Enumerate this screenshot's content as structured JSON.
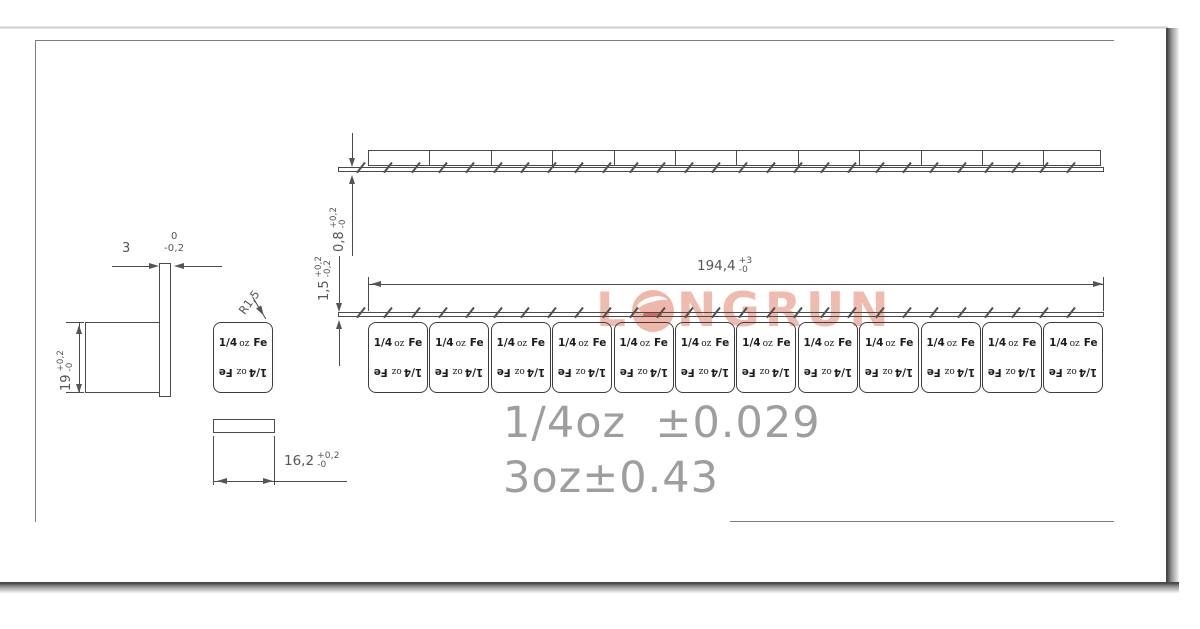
{
  "colors": {
    "drawing_line": "#4a4a4a",
    "dimension_text": "#555555",
    "note_text": "#9e9e9e",
    "watermark": "#eeb0a2"
  },
  "watermark": {
    "first_letter": "L",
    "rest": "NGRUN"
  },
  "weight_block": {
    "fraction": "1/4",
    "unit": "oz",
    "material": "Fe"
  },
  "strip": {
    "segment_count": 12
  },
  "dimensions": {
    "tape_thickness": {
      "value": "0,8",
      "tol_plus": "+0,2",
      "tol_minus": "-0"
    },
    "adhesive_thickness": {
      "value": "1,5",
      "tol_plus": "+0,2",
      "tol_minus": "-0,2"
    },
    "strip_length": {
      "value": "194,4",
      "tol_plus": "+3",
      "tol_minus": "-0"
    },
    "block_thickness": {
      "value": "3",
      "tol_plus": "0",
      "tol_minus": "-0,2"
    },
    "block_height": {
      "value": "19",
      "tol_plus": "+0,2",
      "tol_minus": "-0"
    },
    "block_width": {
      "value": "16,2",
      "tol_plus": "+0,2",
      "tol_minus": "-0"
    },
    "corner_radius": "R1,5"
  },
  "notes": {
    "line1": "1/4oz  ±0.029",
    "line2": "3oz±0.43"
  }
}
